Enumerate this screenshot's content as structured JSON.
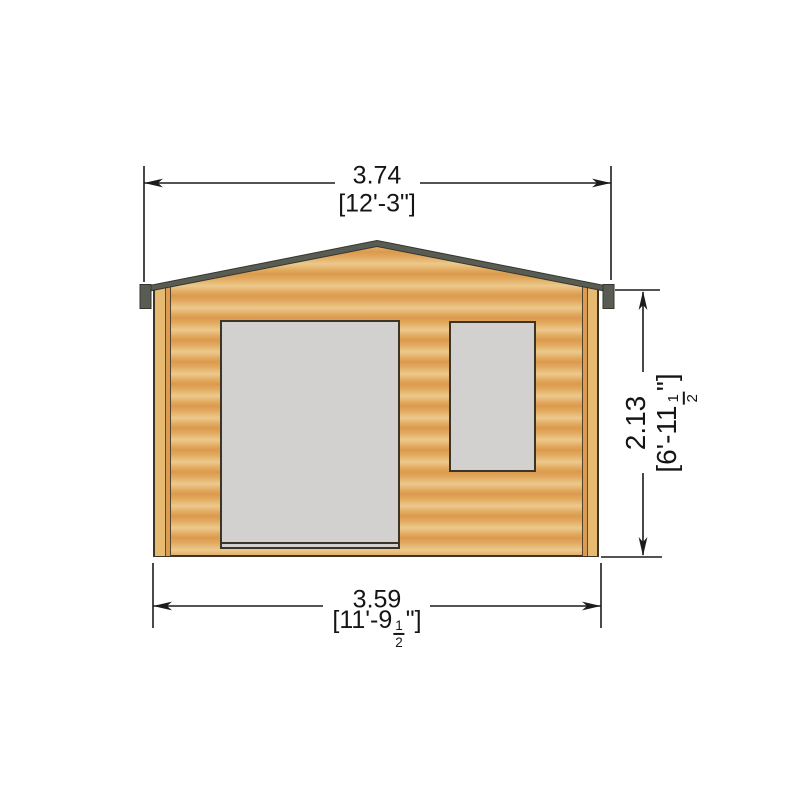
{
  "drawing": {
    "subject": "log-cabin-front-elevation",
    "features": [
      "apex-roof",
      "front-door-opening",
      "window-opening",
      "corner-trim"
    ]
  },
  "dimensions": {
    "top": {
      "metric": "3.74",
      "imperial": "[12'-3\"]"
    },
    "bottom": {
      "metric": "3.59",
      "imperial_prefix": "[11'-9",
      "frac_numerator": "1",
      "frac_denominator": "2",
      "imperial_suffix": "\"]"
    },
    "right": {
      "metric": "2.13",
      "imperial_prefix": "[6'-11",
      "frac_numerator": "1",
      "frac_denominator": "2",
      "imperial_suffix": "\"]"
    }
  },
  "colors": {
    "wood_light": "#ecc98c",
    "wood_mid": "#e2aa60",
    "wood_dark": "#db9a4e",
    "roof_fascia": "#585c52",
    "outline": "#3c3527",
    "opening_fill": "#d2d1cf",
    "dimension_line": "#1c1c1c",
    "background": "#ffffff"
  }
}
